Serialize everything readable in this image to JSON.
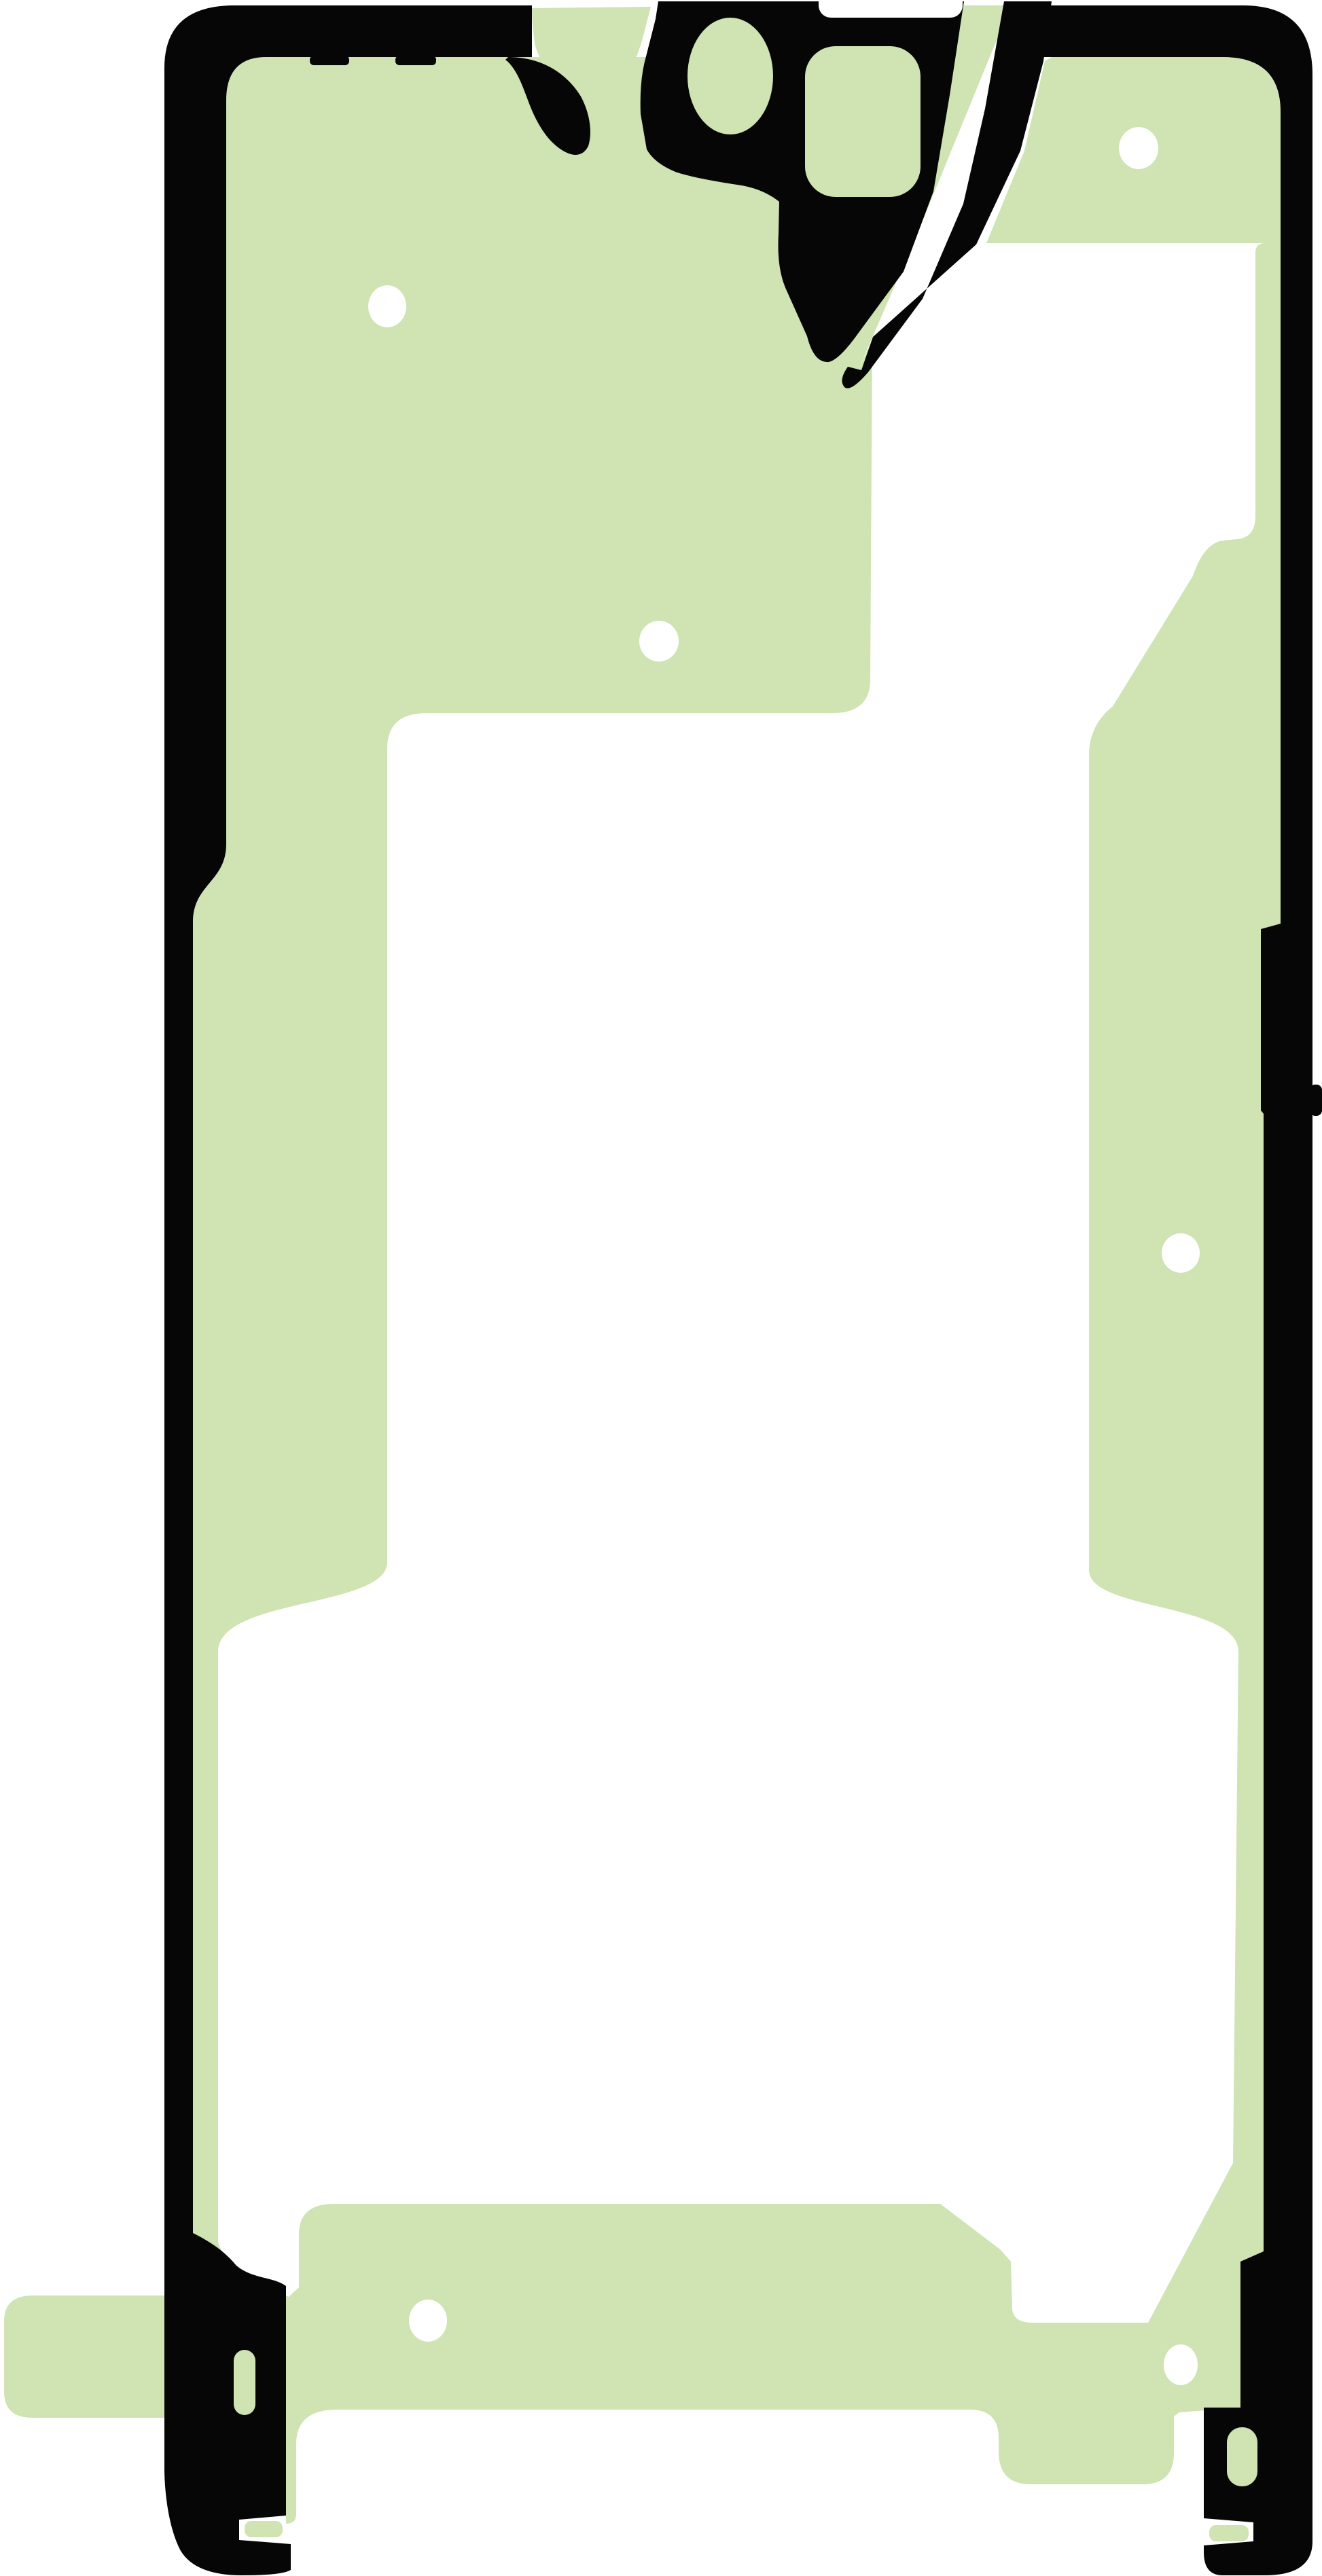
{
  "image": {
    "kind": "product-photo",
    "subject": "smartphone display adhesive sticker (die-cut tape)",
    "orientation": "portrait"
  },
  "colors": {
    "background": "#ffffff",
    "adhesive_green": "#cfe3b3",
    "outline_black": "#060606",
    "hole_white": "#ffffff"
  },
  "features": {
    "alignment_hole_count": 6,
    "slot_count": 2,
    "camera_cutout_count": 2,
    "pull_tab_count": 1
  }
}
